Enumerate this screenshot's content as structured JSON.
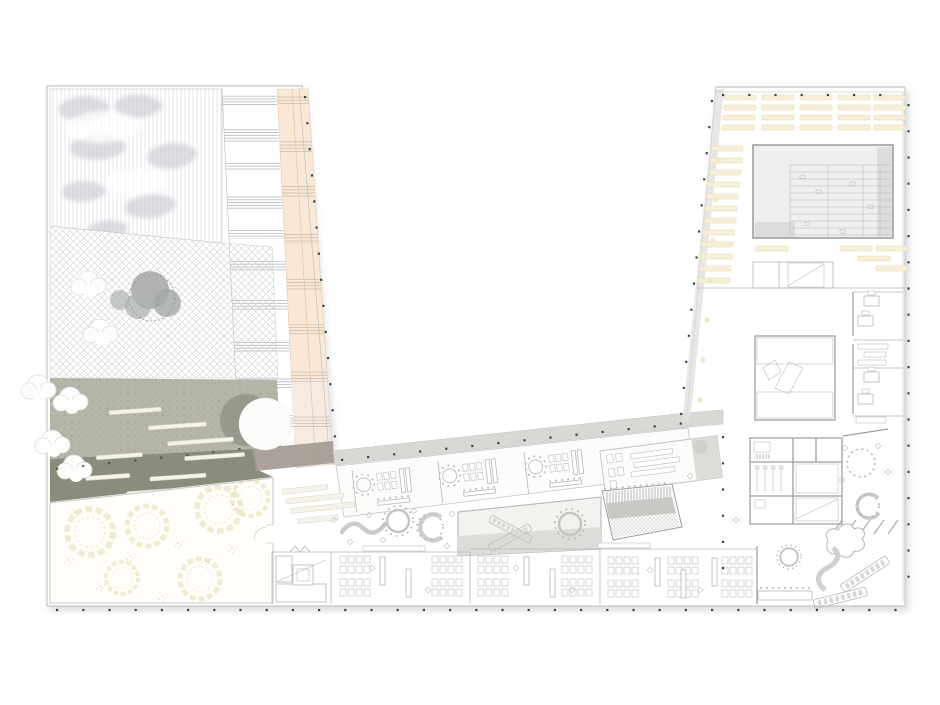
{
  "plan": {
    "type": "architectural floor plan",
    "building_shape": "U-shaped building around a diagonal courtyard",
    "visible_text": [],
    "palette": {
      "paper": "#ffffff",
      "outline": "#c3c7c9",
      "line": "#b4b8bb",
      "wall": "#9aa0a2",
      "dot": "#3f4346",
      "dune_blob": "#bfc4ca",
      "hatch": "#ccd0d0",
      "peach": "#f8e8d5",
      "peach_light": "#f6ebe3",
      "mauve": "#a39a93",
      "green": "#b5b6a8",
      "olive": "#8a8d7d",
      "cream": "#f8efda",
      "cream_edge": "#e9d8ab",
      "ring_yellow": "#e4d8a9",
      "panel": "#f2f2ef",
      "panel_dark": "#dcddd8",
      "gray_band": "#d8d8d5",
      "terrace": "#e1e1de",
      "white_bench": "#f5f3ea",
      "tree_shadow": "#97998c"
    },
    "zones": {
      "dune_garden": {
        "label": "dune roof garden"
      },
      "ramp_terraces": {
        "label": "terraced ramp strip"
      },
      "peach_ramp": {
        "label": "sloped peach walkway"
      },
      "hatched_plaza": {
        "label": "paved courtyard with trees"
      },
      "planted_band": {
        "label": "planted terrace with benches"
      },
      "event_room": {
        "label": "hall with circular seating rings"
      },
      "classroom_wing": {
        "label": "diagonal classroom wing"
      },
      "south_classrooms": {
        "label": "south classroom strip"
      },
      "lounge_deck": {
        "label": "sunken lounge deck"
      },
      "grandstand": {
        "label": "tiered grandstand seating"
      },
      "library": {
        "label": "library hall with shelving"
      },
      "reading_room": {
        "label": "reading room"
      },
      "grand_stair": {
        "label": "main scissor stair"
      },
      "offices": {
        "label": "office row"
      },
      "service_core": {
        "label": "sanitary and service core"
      },
      "informal": {
        "label": "informal seating area"
      }
    }
  }
}
